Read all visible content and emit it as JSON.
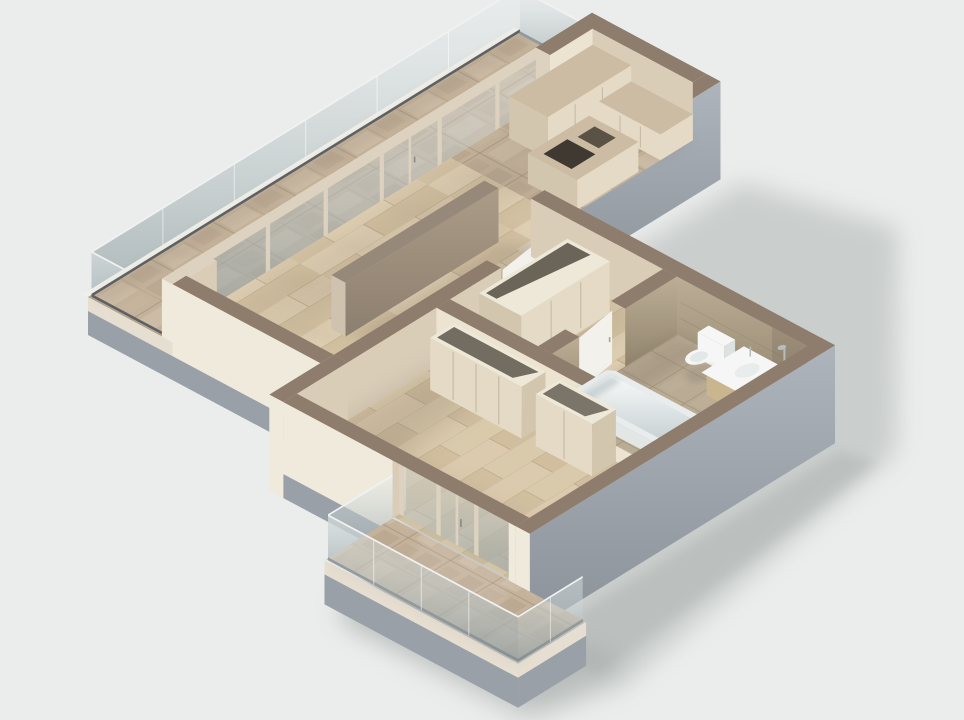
{
  "meta": {
    "kind": "3d-isometric-apartment-floorplan-render"
  },
  "colors": {
    "background": "#ebedec",
    "ground_shadow": "#9aa09e",
    "wall_top": "#8e7d6c",
    "wall_top_dark": "#837463",
    "ext_cream": "#f0eadd",
    "slab_cream": "#e6dfd1",
    "base_gray": "#99a0a7",
    "gray_light": "#adb4bb",
    "gray_dark": "#8b9299",
    "int_cream_lit": "#ece3d1",
    "int_cream_shade": "#d9cdb8",
    "frame_cream": "#dcd2bf",
    "glass_top": "#f0f2f2",
    "glass_hi": "#e6ecec",
    "glass_lo": "#94a2a5",
    "rail_dark": "#5d6164",
    "trav_base": "#c4b29b",
    "trav_light": "#d2c3ad",
    "trav_dark": "#b2a089",
    "trav_line": "#9c8b74",
    "wood_base": "#d9c8ab",
    "wood_light": "#e1d3b8",
    "wood_dark": "#cbb795",
    "wood_line": "#aa9878",
    "bath_floor": "#b9ab94",
    "bath_line": "#8f7f66",
    "stone_wall_hi": "#bcae96",
    "stone_wall_lo": "#92856d",
    "furn_cream": "#e4dac5",
    "furn_shade": "#d2c6ae",
    "furn_top": "#eee8d9",
    "trav_top": "#cdbca4",
    "white": "#f5f6f5",
    "white_shade": "#dde2e1",
    "tub_hi": "#f8fafa",
    "tub_lo": "#c7d1d3",
    "wood_vanity": "#c9b68f",
    "dark_inset": "#3f3931",
    "dark_inset2": "#5a5244",
    "chrome": "#b7bcbe",
    "door_white": "#f3f1eb",
    "panel_hi": "#ab9b87",
    "panel_lo": "#8d7f6f",
    "panel_edge": "#cfc3b0",
    "shadow_warm": "#6f6251",
    "closet_dark": "#4a4338"
  },
  "scene": {
    "rooms": [
      "main-balcony",
      "living-room",
      "kitchen",
      "hallway",
      "bathroom",
      "bedroom",
      "lower-balcony"
    ],
    "fixtures": [
      "glass-balustrade",
      "floor-to-ceiling-windows",
      "kitchen-counter",
      "kitchen-island",
      "media-partition-wall",
      "hall-wardrobe",
      "bedroom-wardrobes",
      "bathtub",
      "toilet",
      "vanity-sink",
      "shower-fixtures",
      "bathroom-door",
      "bedroom-door",
      "sliding-balcony-door"
    ]
  }
}
